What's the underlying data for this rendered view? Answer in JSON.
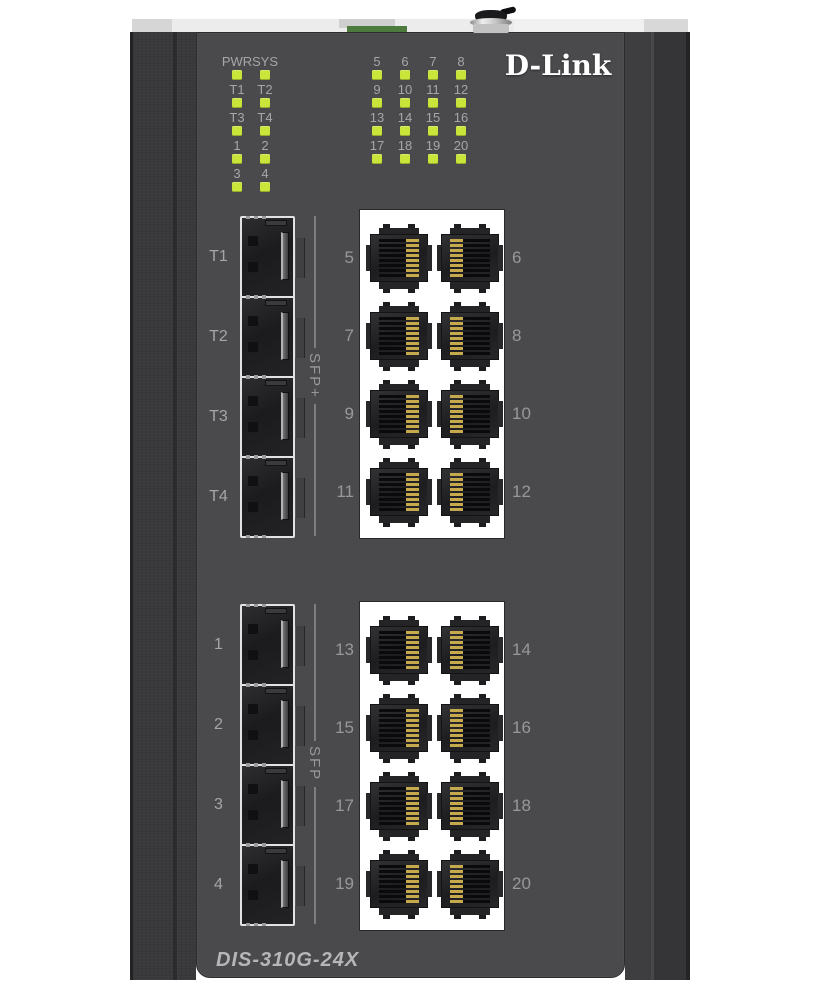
{
  "product": {
    "brand": "D-Link",
    "model": "DIS-310G-24X"
  },
  "colors": {
    "page_bg": "#ffffff",
    "panel": "#4a4a4c",
    "rail": "#39393b",
    "led": "#c9e53a",
    "label_text": "#a6a6a8",
    "port_number_text": "#98989a",
    "model_text": "#b6b6b8",
    "logo_text": "#ffffff",
    "rj45_panel_bg": "#ffffff",
    "terminal_green": "#4d7b3e",
    "gold_pins": "#c7a94d"
  },
  "led_panel": {
    "left_group": {
      "rows": [
        [
          "PWR",
          "SYS"
        ],
        [
          "T1",
          "T2"
        ],
        [
          "T3",
          "T4"
        ],
        [
          "1",
          "2"
        ],
        [
          "3",
          "4"
        ]
      ]
    },
    "right_group": {
      "rows": [
        [
          "5",
          "6",
          "7",
          "8"
        ],
        [
          "9",
          "10",
          "11",
          "12"
        ],
        [
          "13",
          "14",
          "15",
          "16"
        ],
        [
          "17",
          "18",
          "19",
          "20"
        ]
      ]
    }
  },
  "upper_ports": {
    "sfp_group_label": "SFP+",
    "sfp_ports": [
      "T1",
      "T2",
      "T3",
      "T4"
    ],
    "rj45_rows": [
      {
        "left": "5",
        "right": "6"
      },
      {
        "left": "7",
        "right": "8"
      },
      {
        "left": "9",
        "right": "10"
      },
      {
        "left": "11",
        "right": "12"
      }
    ]
  },
  "lower_ports": {
    "sfp_group_label": "SFP",
    "sfp_ports": [
      "1",
      "2",
      "3",
      "4"
    ],
    "rj45_rows": [
      {
        "left": "13",
        "right": "14"
      },
      {
        "left": "15",
        "right": "16"
      },
      {
        "left": "17",
        "right": "18"
      },
      {
        "left": "19",
        "right": "20"
      }
    ]
  }
}
